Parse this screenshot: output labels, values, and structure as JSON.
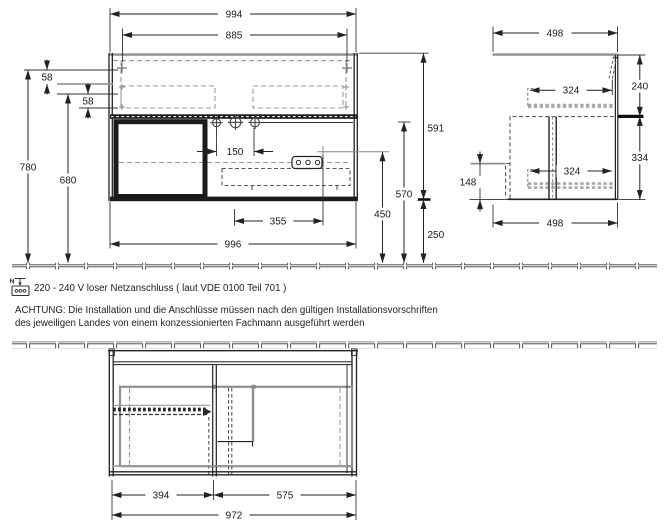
{
  "notes": {
    "power": "220 - 240 V loser Netzanschluss ( laut VDE 0100 Teil 701 )",
    "warning1": "ACHTUNG: Die Installation und die Anschlüsse müssen nach den gültigen Installationsvorschriften",
    "warning2": "des jeweiligen Landes von einem konzessionierten Fachmann ausgeführt werden"
  },
  "front": {
    "width_top": "994",
    "width_hanger": "885",
    "hanger_offset_top": "58",
    "hanger_offset_bottom": "58",
    "height_total": "780",
    "height_basin": "680",
    "hole_spacing": "150",
    "drain_offset": "355",
    "width_cabinet": "996",
    "cabinet_height": "591",
    "rail_height": "570",
    "drain_height": "450",
    "floor_clearance": "250"
  },
  "side": {
    "depth_top": "498",
    "cutout_top": "324",
    "apron_height": "240",
    "body_height": "334",
    "drain_height": "148",
    "cutout_bottom": "324",
    "depth_bottom": "498"
  },
  "plan": {
    "drawer_width": "394",
    "open_width": "575",
    "total_width": "972"
  }
}
